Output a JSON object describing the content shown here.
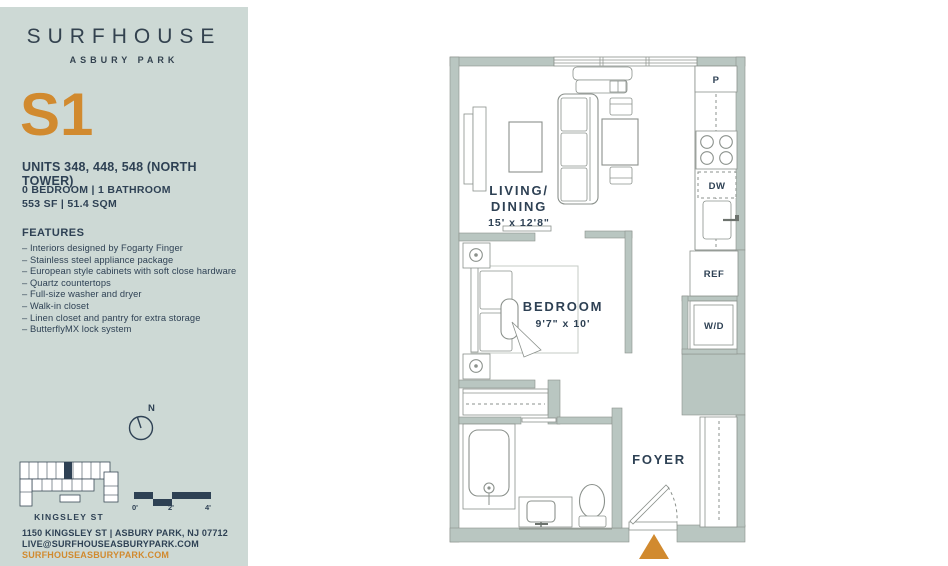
{
  "colors": {
    "accent_orange": "#d18a2f",
    "navy": "#2e4154",
    "sidebar_bg": "#cdd9d5",
    "wall_fill": "#b9c6c1",
    "line_gray": "#8b918c"
  },
  "sidebar": {
    "logo": {
      "title": "SURFHOUSE",
      "subtitle": "ASBURY PARK"
    },
    "unit_code": "S1",
    "units_line": "UNITS 348, 448, 548 (NORTH TOWER)",
    "bed_bath": "0 BEDROOM | 1 BATHROOM",
    "area": "553 SF | 51.4 SQM",
    "features": {
      "title": "FEATURES",
      "items": [
        "Interiors designed by Fogarty Finger",
        "Stainless steel appliance package",
        "European style cabinets with soft close hardware",
        "Quartz countertops",
        "Full-size washer and dryer",
        "Walk-in closet",
        "Linen closet and pantry for extra storage",
        "ButterflyMX lock system"
      ]
    },
    "compass_label": "N",
    "keyplan_street": "KINGSLEY ST",
    "scale": {
      "t0": "0'",
      "t2": "2'",
      "t4": "4'"
    },
    "address_line1": "1150 KINGSLEY ST | ASBURY PARK, NJ 07712",
    "address_line2": "LIVE@SURFHOUSEASBURYPARK.COM",
    "website": "SURFHOUSEASBURYPARK.COM"
  },
  "floorplan": {
    "living": {
      "line1": "LIVING/",
      "line2": "DINING",
      "dims": "15' x 12'8\""
    },
    "bedroom": {
      "name": "BEDROOM",
      "dims": "9'7\" x 10'"
    },
    "foyer": {
      "name": "FOYER"
    },
    "labels": {
      "pantry": "P",
      "dishwasher": "DW",
      "refrigerator": "REF",
      "washer_dryer": "W/D"
    }
  }
}
